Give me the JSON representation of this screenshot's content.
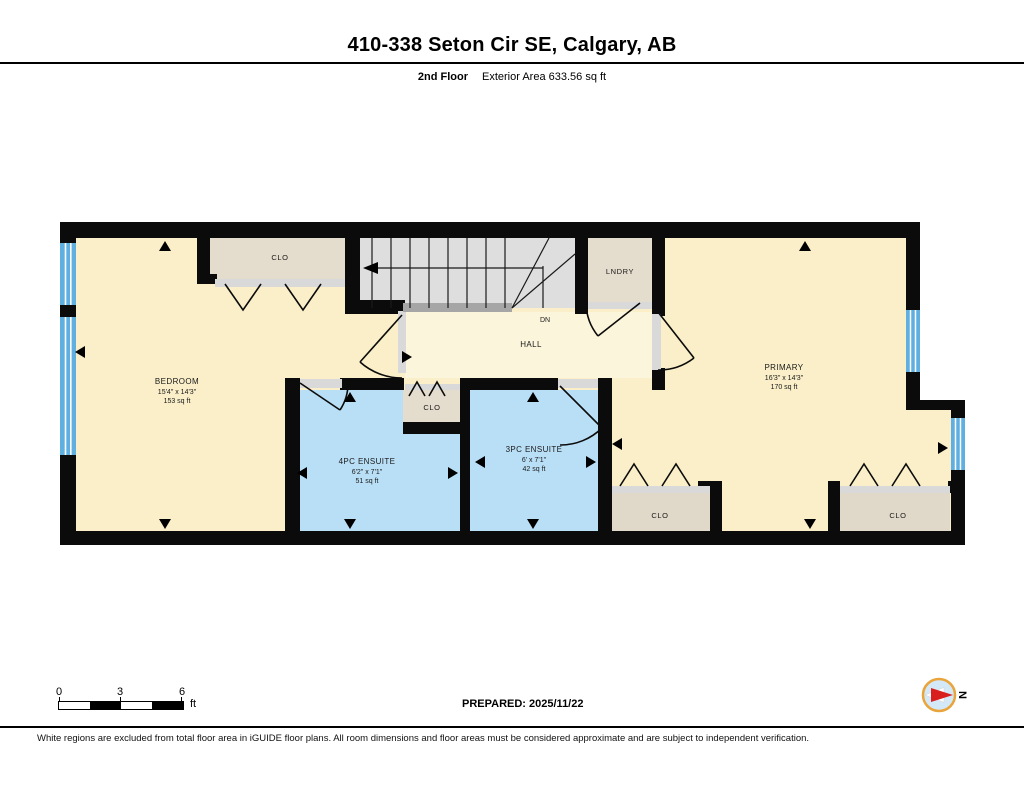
{
  "header": {
    "title": "410-338 Seton Cir SE, Calgary, AB",
    "floor": "2nd Floor",
    "area": "Exterior Area 633.56 sq ft"
  },
  "plan": {
    "bedroom": {
      "name": "BEDROOM",
      "dims": "15'4\" x 14'3\"",
      "area": "153 sq ft"
    },
    "primary": {
      "name": "PRIMARY",
      "dims": "16'3\" x 14'3\"",
      "area": "170 sq ft"
    },
    "ensuite4": {
      "name": "4PC ENSUITE",
      "dims": "6'2\" x 7'1\"",
      "area": "51 sq ft"
    },
    "ensuite3": {
      "name": "3PC ENSUITE",
      "dims": "6' x 7'1\"",
      "area": "42 sq ft"
    },
    "hall": "HALL",
    "dn": "DN",
    "laundry": "LNDRY",
    "closet_top": "CLO",
    "closet_small": "CLO",
    "closet_mid": "CLO",
    "closet_right": "CLO"
  },
  "legend": {
    "scale_ticks": [
      "0",
      "3",
      "6"
    ],
    "scale_unit": "ft",
    "prepared": "PREPARED: 2025/11/22",
    "compass_north": "N"
  },
  "colors": {
    "room_yellow": "#FAEFC9",
    "hall_cream": "#FBF5DB",
    "ensuite_blue": "#B9DFF6",
    "closet_beige": "#E4DCCC",
    "stairs_gray": "#DEDEDE",
    "window_blue": "#5FAFE0",
    "wall_black": "#0B0B0B",
    "compass_ring": "#E9A43B",
    "compass_red": "#D91E1E"
  },
  "footer": "White regions are excluded from total floor area in iGUIDE floor plans. All room dimensions and floor areas must be considered approximate and are subject to independent verification."
}
